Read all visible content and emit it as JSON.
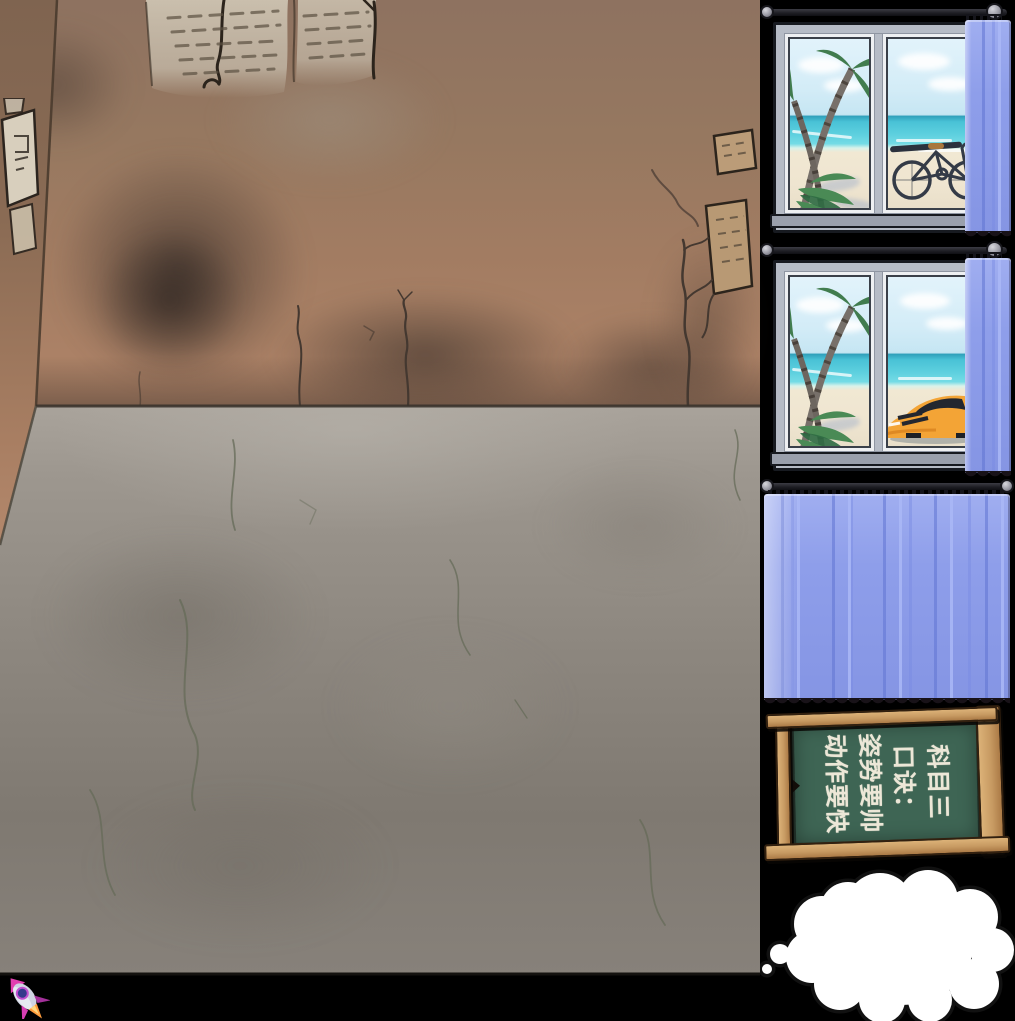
{
  "chalkboard": {
    "lines": [
      "科目三",
      "口诀：",
      "姿势要帅",
      "动作要快"
    ]
  },
  "icons": {
    "rocket": "rocket-icon",
    "thought_bubble": "thought-bubble-icon",
    "curtain_rod": "curtain-rod",
    "curtain_finial": "rod-finial"
  },
  "colors": {
    "background": "#000000",
    "wall_top": "#8e7260",
    "wall_bottom": "#b08468",
    "side_wall": "#7f6450",
    "floor": "#8b857d",
    "curtain": "#8c9ce8",
    "curtain_fold": "#6e82d8",
    "window_frame": "#b6bcc6",
    "sky": "#d8eef8",
    "sea": "#49c2d6",
    "sand": "#f0e7d2",
    "car": "#f3a436",
    "board_green": "#3e6554",
    "frame_wood": "#c79a62",
    "chalk": "#ece7d7"
  }
}
